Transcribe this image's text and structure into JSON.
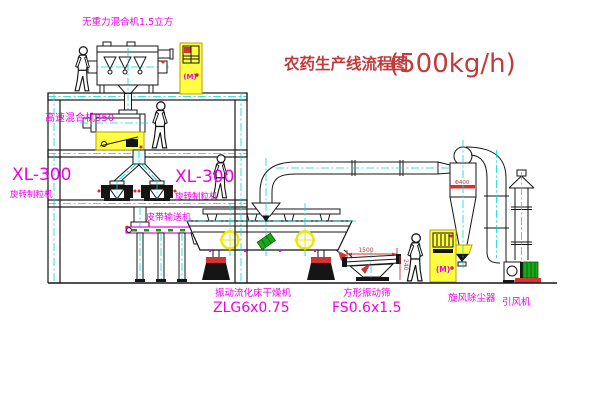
{
  "title": {
    "text": "农药生产线流程图",
    "capacity": "(500kg/h)"
  },
  "labels": {
    "gravity_mixer": "无重力混合机1.5立方",
    "high_speed_mixer": "高速混合机350",
    "granulator_model": "XL-300",
    "granulator_name": "旋转制粒机",
    "belt_conveyor": "皮带输送机",
    "dryer_name": "振动流化床干燥机",
    "dryer_model": "ZLG6x0.75",
    "screen_name": "方形振动筛",
    "screen_model": "FS0.6x1.5",
    "cyclone_name": "旋风除尘器",
    "cyclone_dim": "Φ400",
    "fan_name": "引风机",
    "dim_width": "1500",
    "dim_height": "240",
    "cabinet_mark": "(M)"
  },
  "colors": {
    "label_magenta": "#ee00ee",
    "title_red": "#c23b3b",
    "centerline_cyan": "#00d9d9",
    "equipment_yellow": "#ffff42",
    "accent_red": "#d23333",
    "motor_green": "#18a818"
  }
}
